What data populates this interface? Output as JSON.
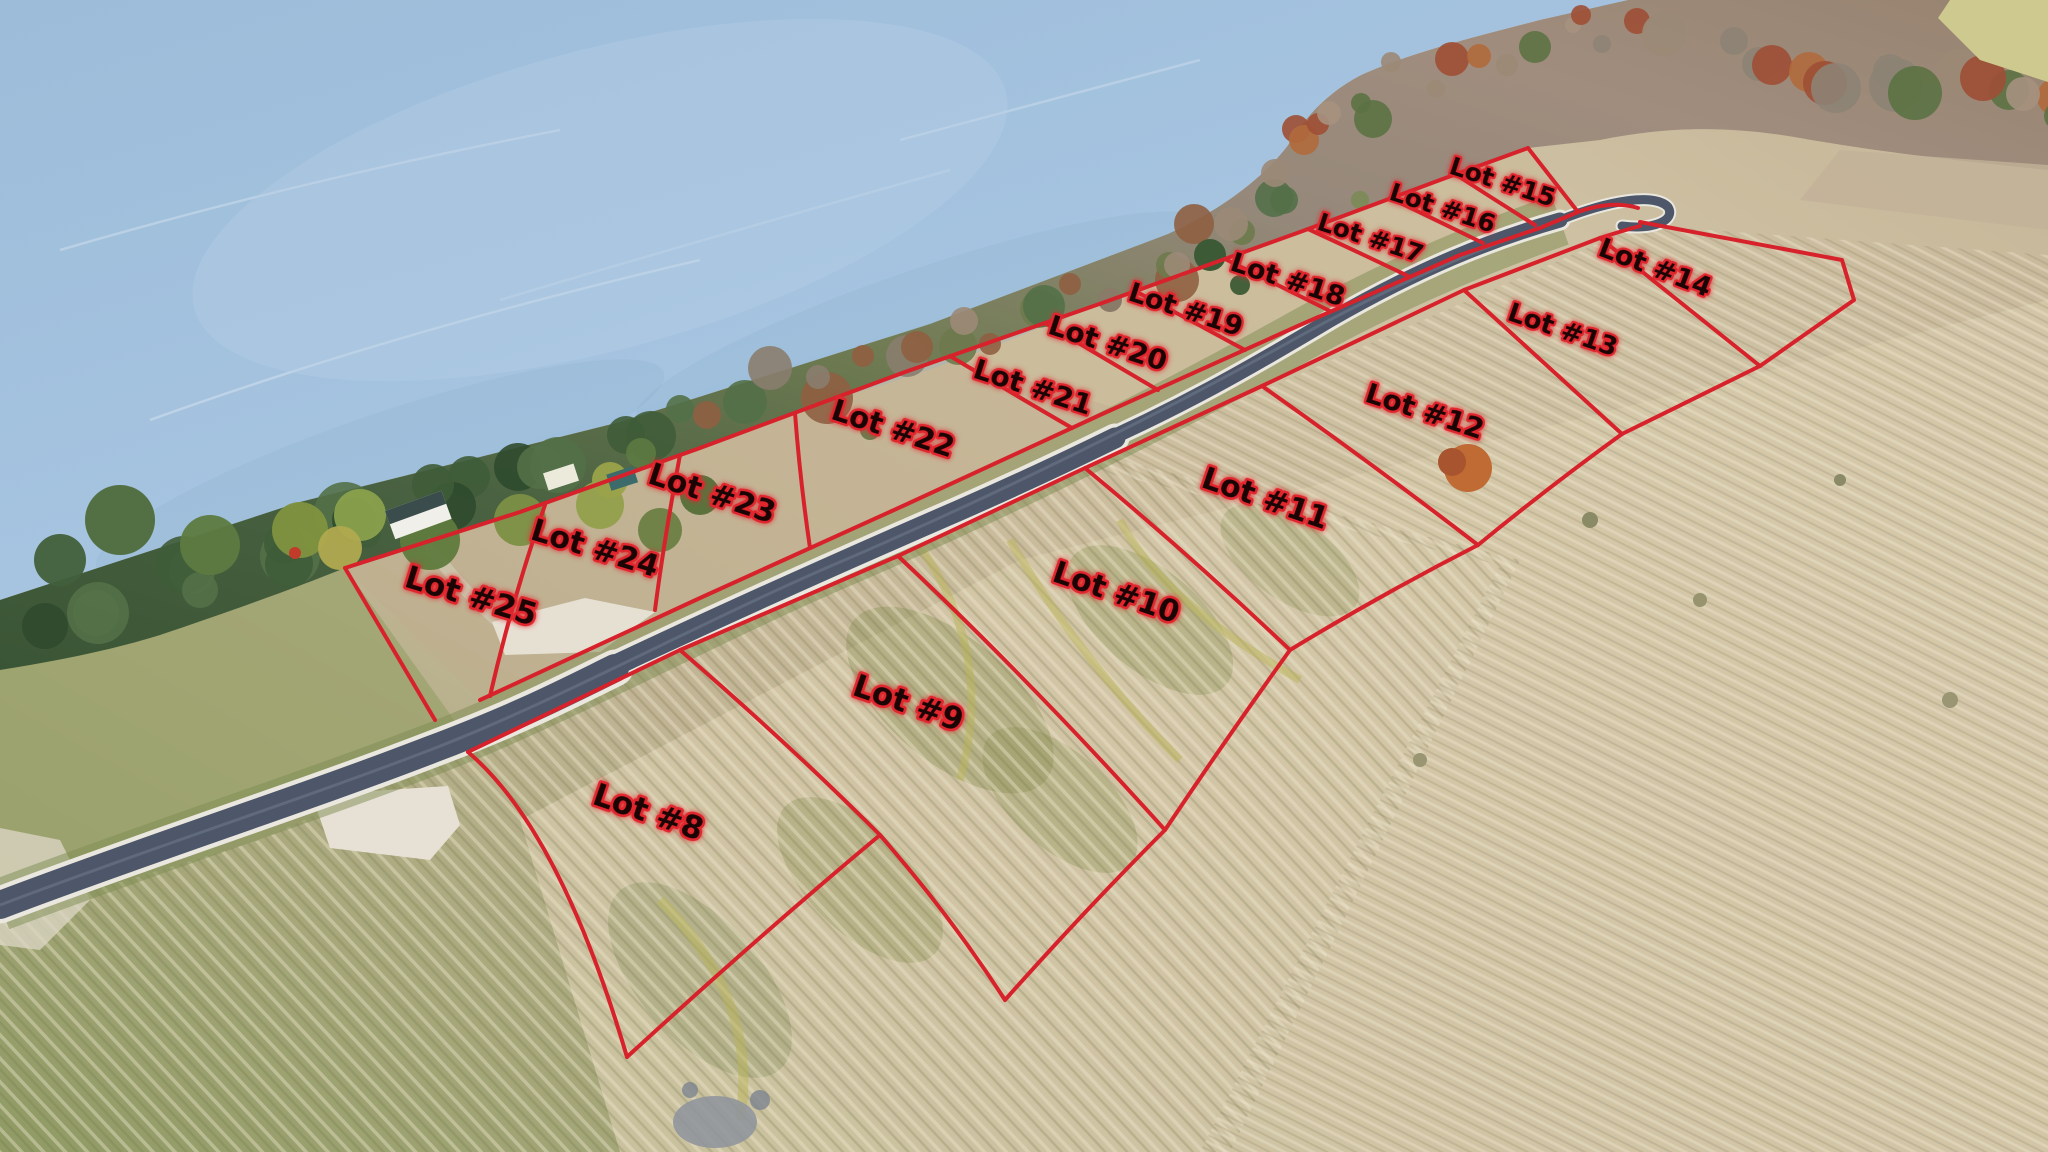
{
  "image_type": "aerial-drone-photo-with-lot-overlay",
  "description": "Aerial photo of lakefront acreage subdivision: lake upper-left, tree-lined shore, paved road running diagonally with cul-de-sac hook, red plat lines marking lots",
  "palette": {
    "line": "#d7222b",
    "labelFill": "#1a0404",
    "labelStroke": "#e1262e",
    "water": "#a3c1dd",
    "waterDeep": "#95b7d5",
    "waterStreak": "#d7e4ef",
    "roadAsphalt": "#4d5769",
    "roadSheen": "#737d92",
    "roadEdge": "#eae7df",
    "verge": "#7e8c52",
    "fieldGreen": "#8f9a64",
    "fieldTan": "#c8bb9c",
    "fieldPale": "#d6c9ab",
    "gravel": "#e8e3d6",
    "treeDark": "#33502f",
    "treeGray": "#9b8a77",
    "treeRust": "#b06a3c",
    "houseWall": "#f0efe9",
    "houseRoof": "#3a4c4c",
    "shedTeal": "#3d6b6b",
    "stones": "#8d939c"
  },
  "overlay": {
    "lots": [
      {
        "id": 8,
        "label": "Lot #8",
        "x": 645,
        "y": 822,
        "rot": 19,
        "size": 31
      },
      {
        "id": 9,
        "label": "Lot #9",
        "x": 905,
        "y": 713,
        "rot": 19,
        "size": 31
      },
      {
        "id": 10,
        "label": "Lot #10",
        "x": 1113,
        "y": 602,
        "rot": 19,
        "size": 30
      },
      {
        "id": 11,
        "label": "Lot #11",
        "x": 1262,
        "y": 508,
        "rot": 19,
        "size": 30
      },
      {
        "id": 12,
        "label": "Lot #12",
        "x": 1422,
        "y": 420,
        "rot": 18,
        "size": 28
      },
      {
        "id": 13,
        "label": "Lot #13",
        "x": 1560,
        "y": 338,
        "rot": 19,
        "size": 26
      },
      {
        "id": 14,
        "label": "Lot #14",
        "x": 1652,
        "y": 276,
        "rot": 21,
        "size": 27
      },
      {
        "id": 15,
        "label": "Lot #15",
        "x": 1500,
        "y": 190,
        "rot": 18,
        "size": 25
      },
      {
        "id": 16,
        "label": "Lot #16",
        "x": 1440,
        "y": 216,
        "rot": 18,
        "size": 25
      },
      {
        "id": 17,
        "label": "Lot #17",
        "x": 1368,
        "y": 246,
        "rot": 18,
        "size": 25
      },
      {
        "id": 18,
        "label": "Lot #18",
        "x": 1285,
        "y": 288,
        "rot": 18,
        "size": 27
      },
      {
        "id": 19,
        "label": "Lot #19",
        "x": 1183,
        "y": 318,
        "rot": 18,
        "size": 27
      },
      {
        "id": 20,
        "label": "Lot #20",
        "x": 1105,
        "y": 352,
        "rot": 18,
        "size": 28
      },
      {
        "id": 21,
        "label": "Lot #21",
        "x": 1030,
        "y": 396,
        "rot": 18,
        "size": 28
      },
      {
        "id": 22,
        "label": "Lot #22",
        "x": 890,
        "y": 438,
        "rot": 18,
        "size": 29
      },
      {
        "id": 23,
        "label": "Lot #23",
        "x": 709,
        "y": 503,
        "rot": 18,
        "size": 30
      },
      {
        "id": 24,
        "label": "Lot #24",
        "x": 592,
        "y": 558,
        "rot": 17,
        "size": 30
      },
      {
        "id": 25,
        "label": "Lot #25",
        "x": 468,
        "y": 606,
        "rot": 17,
        "size": 31
      }
    ]
  }
}
